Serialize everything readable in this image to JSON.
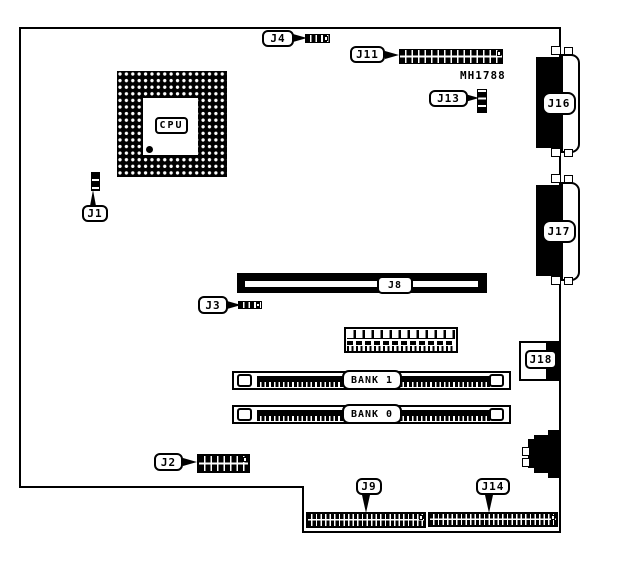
{
  "board": {
    "part_number": "MH1788",
    "cpu": {
      "label": "CPU"
    },
    "connector_labels": {
      "j1": "J1",
      "j2": "J2",
      "j3": "J3",
      "j4": "J4",
      "j8": "J8",
      "j9": "J9",
      "j11": "J11",
      "j13": "J13",
      "j14": "J14",
      "j16": "J16",
      "j17": "J17",
      "j18": "J18"
    },
    "memory_banks": {
      "bank1": "BANK 1",
      "bank0": "BANK 0"
    }
  },
  "colors": {
    "line": "#000000",
    "background": "#ffffff"
  }
}
